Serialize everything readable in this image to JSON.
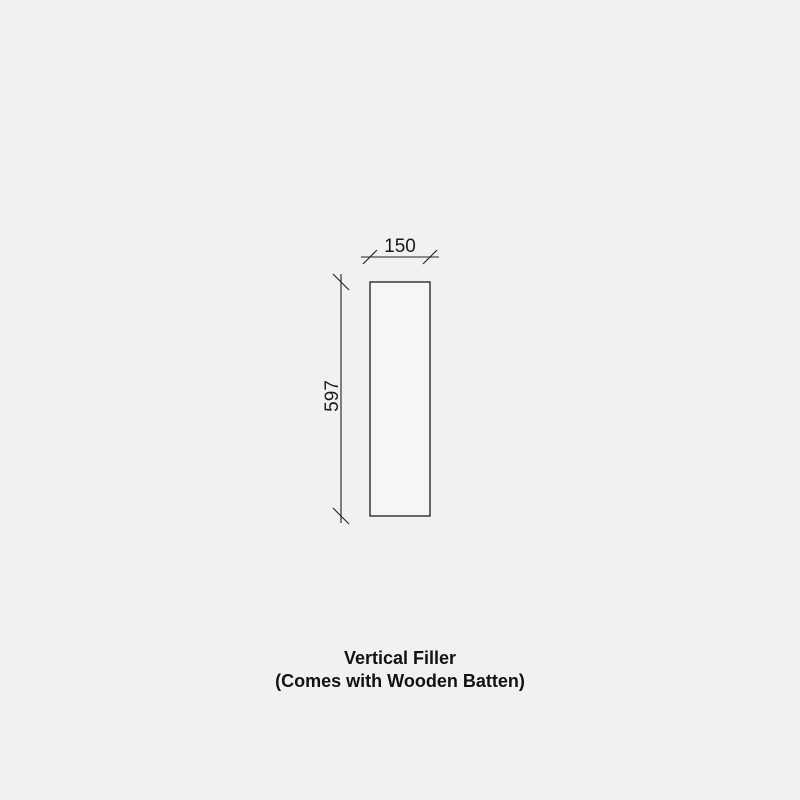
{
  "page": {
    "background_color": "#f0f1f1"
  },
  "diagram": {
    "kind": "dimensioned-elevation-drawing",
    "line_color": "#1c1c1c",
    "panel_fill": "#f5f6f6",
    "width_dimension": {
      "label": "150"
    },
    "height_dimension": {
      "label": "597"
    }
  },
  "caption": {
    "line1": "Vertical Filler",
    "line2": "(Comes with Wooden Batten)"
  }
}
